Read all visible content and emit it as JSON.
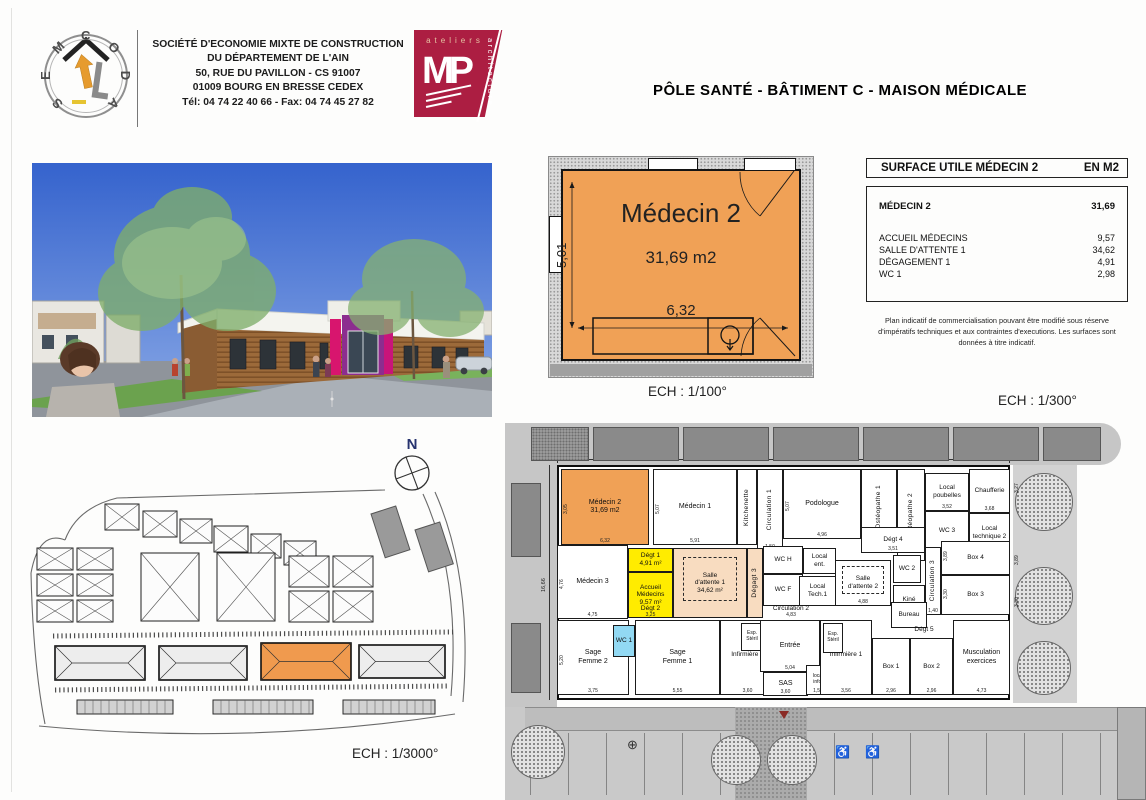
{
  "header": {
    "semcoda_name": "SEMCODA",
    "company_lines": [
      "SOCIÉTÉ D'ECONOMIE MIXTE DE CONSTRUCTION",
      "DU DÉPARTEMENT DE L'AIN",
      "50, RUE DU PAVILLON - CS 91007",
      "01009 BOURG EN BRESSE CEDEX",
      "Tél: 04 74 22 40 66 - Fax: 04 74 45 27 82"
    ],
    "mp_logo": {
      "word_top": "ateliers",
      "word_side": "architecture",
      "initials": "MP"
    },
    "title": "PÔLE SANTÉ - BÂTIMENT C - MAISON MÉDICALE"
  },
  "detail_plan": {
    "room_name": "Médecin 2",
    "area_label": "31,69 m2",
    "dim_width": "6,32",
    "dim_height": "5,01",
    "scale_label": "ECH : 1/100°"
  },
  "surface_table": {
    "title": "SURFACE UTILE MÉDECIN 2",
    "unit": "EN M2",
    "main_row": {
      "label": "MÉDECIN 2",
      "value": "31,69"
    },
    "rows": [
      {
        "label": "ACCUEIL MÉDECINS",
        "value": "9,57"
      },
      {
        "label": "SALLE D'ATTENTE 1",
        "value": "34,62"
      },
      {
        "label": "DÉGAGEMENT 1",
        "value": "4,91"
      },
      {
        "label": "WC 1",
        "value": "2,98"
      }
    ],
    "note": "Plan indicatif de commercialisation pouvant être modifié sous réserve d'impératifs techniques et aux contraintes d'executions. Les surfaces sont données à titre indicatif."
  },
  "site_plan": {
    "north_label": "N",
    "scale_label": "ECH : 1/3000°",
    "roads": [
      "M40,62 Q52,30 92,20 L360,12",
      "M398,16 Q436,100 426,218",
      "M410,14 Q448,100 438,224",
      "M14,248 Q225,268 430,236",
      "M6,95 Q8,185 20,246",
      "M6,95 Q14,52 40,62"
    ],
    "parking_lines": [
      {
        "x1": 28,
        "y1": 158,
        "x2": 428,
        "y2": 154
      },
      {
        "x1": 30,
        "y1": 212,
        "x2": 424,
        "y2": 208
      }
    ],
    "houses": [
      {
        "x": 80,
        "y": 26,
        "w": 34,
        "h": 26
      },
      {
        "x": 118,
        "y": 33,
        "w": 34,
        "h": 26
      },
      {
        "x": 155,
        "y": 41,
        "w": 32,
        "h": 24
      },
      {
        "x": 189,
        "y": 48,
        "w": 34,
        "h": 26
      },
      {
        "x": 226,
        "y": 56,
        "w": 30,
        "h": 24
      },
      {
        "x": 259,
        "y": 63,
        "w": 32,
        "h": 24
      },
      {
        "x": 12,
        "y": 70,
        "w": 36,
        "h": 22
      },
      {
        "x": 52,
        "y": 70,
        "w": 36,
        "h": 22
      },
      {
        "x": 12,
        "y": 96,
        "w": 36,
        "h": 22
      },
      {
        "x": 52,
        "y": 96,
        "w": 36,
        "h": 22
      },
      {
        "x": 12,
        "y": 122,
        "w": 36,
        "h": 22
      },
      {
        "x": 52,
        "y": 122,
        "w": 36,
        "h": 22
      },
      {
        "x": 116,
        "y": 75,
        "w": 58,
        "h": 68
      },
      {
        "x": 192,
        "y": 75,
        "w": 58,
        "h": 68
      },
      {
        "x": 264,
        "y": 78,
        "w": 40,
        "h": 31
      },
      {
        "x": 308,
        "y": 78,
        "w": 40,
        "h": 31
      },
      {
        "x": 264,
        "y": 113,
        "w": 40,
        "h": 31
      },
      {
        "x": 308,
        "y": 113,
        "w": 40,
        "h": 31
      }
    ],
    "slabs": [
      {
        "x": 346,
        "y": 36,
        "w": 26,
        "h": 46,
        "rot": -18
      },
      {
        "x": 390,
        "y": 52,
        "w": 26,
        "h": 44,
        "rot": -18
      }
    ],
    "long_buildings": [
      {
        "x": 30,
        "y": 168,
        "w": 90,
        "h": 34,
        "fill": "#ededed"
      },
      {
        "x": 134,
        "y": 168,
        "w": 88,
        "h": 34,
        "fill": "#ededed"
      },
      {
        "x": 236,
        "y": 165,
        "w": 90,
        "h": 37,
        "fill": "#f09a4e"
      },
      {
        "x": 334,
        "y": 167,
        "w": 86,
        "h": 33,
        "fill": "#ededed"
      }
    ],
    "garages": [
      {
        "x": 52,
        "y": 222,
        "w": 96,
        "h": 14
      },
      {
        "x": 188,
        "y": 222,
        "w": 100,
        "h": 14
      },
      {
        "x": 318,
        "y": 222,
        "w": 92,
        "h": 14
      }
    ]
  },
  "floor_plan": {
    "scale_label": "ECH : 1/300°",
    "dim_top": "34,56",
    "dim_left": "16,66",
    "canopy_panels": [
      {
        "x": 26,
        "y": 12,
        "w": 58,
        "h": 34,
        "speckled": true
      },
      {
        "x": 88,
        "y": 12,
        "w": 86,
        "h": 34
      },
      {
        "x": 178,
        "y": 12,
        "w": 86,
        "h": 34
      },
      {
        "x": 268,
        "y": 12,
        "w": 86,
        "h": 34
      },
      {
        "x": 358,
        "y": 12,
        "w": 86,
        "h": 34
      },
      {
        "x": 448,
        "y": 12,
        "w": 86,
        "h": 34
      },
      {
        "x": 538,
        "y": 12,
        "w": 58,
        "h": 34
      }
    ],
    "side_panels": [
      {
        "x": 6,
        "y": 68,
        "w": 30,
        "h": 74
      },
      {
        "x": 6,
        "y": 208,
        "w": 30,
        "h": 70
      }
    ],
    "trees": [
      {
        "x": 510,
        "y": 58,
        "d": 56
      },
      {
        "x": 510,
        "y": 152,
        "d": 56
      },
      {
        "x": 512,
        "y": 226,
        "d": 52
      },
      {
        "x": 6,
        "y": 310,
        "d": 52
      },
      {
        "x": 206,
        "y": 320,
        "d": 48
      },
      {
        "x": 262,
        "y": 320,
        "d": 48
      }
    ],
    "side_dims": [
      {
        "label": "3,27",
        "x": 509,
        "y": 78
      },
      {
        "label": "3,89",
        "x": 509,
        "y": 150
      },
      {
        "label": "3,30",
        "x": 509,
        "y": 192
      }
    ],
    "rooms": [
      {
        "id": "medecin-2",
        "label": "Médecin 2",
        "area": "31,69 m2",
        "x": 56,
        "y": 54,
        "w": 88,
        "h": 76,
        "fill": "#f0a156",
        "dim": "6,32",
        "vdim": "3,05",
        "fs": 7
      },
      {
        "id": "medecin-1",
        "label": "Médecin 1",
        "x": 148,
        "y": 54,
        "w": 84,
        "h": 76,
        "dim": "5,91",
        "vdim": "5,07",
        "fs": 7
      },
      {
        "id": "kitchenette",
        "label": "Kitchenette",
        "x": 232,
        "y": 54,
        "w": 20,
        "h": 76,
        "vertical": true
      },
      {
        "id": "circulation-1",
        "label": "Circulation 1",
        "x": 252,
        "y": 54,
        "w": 26,
        "h": 82,
        "vertical": true,
        "dim": "1,50"
      },
      {
        "id": "podologue",
        "label": "Podologue",
        "x": 278,
        "y": 54,
        "w": 78,
        "h": 70,
        "dim": "4,96",
        "vdim": "5,07",
        "fs": 7
      },
      {
        "id": "osteopathe-1",
        "label": "Ostéopathe 1",
        "x": 356,
        "y": 54,
        "w": 36,
        "h": 76,
        "vertical": true,
        "dim": "3,97"
      },
      {
        "id": "osteopathe-2",
        "label": "Ostéopathe 2",
        "x": 392,
        "y": 54,
        "w": 28,
        "h": 92,
        "vertical": true
      },
      {
        "id": "local-poubelles",
        "label": "Local\npoubelles",
        "x": 420,
        "y": 58,
        "w": 44,
        "h": 38,
        "dim": "3,52"
      },
      {
        "id": "wc-3",
        "label": "WC 3",
        "x": 420,
        "y": 96,
        "w": 44,
        "h": 40
      },
      {
        "id": "chaufferie",
        "label": "Chaufferie",
        "x": 464,
        "y": 54,
        "w": 41,
        "h": 44,
        "dim": "3,68"
      },
      {
        "id": "local-technique-2",
        "label": "Local\ntechnique 2",
        "x": 464,
        "y": 98,
        "w": 41,
        "h": 40
      },
      {
        "id": "degt-4",
        "label": "Dégt 4",
        "x": 356,
        "y": 112,
        "w": 64,
        "h": 26,
        "dim": "3,51"
      },
      {
        "id": "medecin-3",
        "label": "Médecin 3",
        "x": 52,
        "y": 130,
        "w": 71,
        "h": 74,
        "dim": "4,75",
        "vdim": "4,76",
        "fs": 7
      },
      {
        "id": "degt-1",
        "label": "Dégt 1\n4,91 m²",
        "x": 123,
        "y": 133,
        "w": 45,
        "h": 24,
        "fill": "#ffec00"
      },
      {
        "id": "accueil-medecins",
        "label": "Accueil\nMédecins\n9,57 m²",
        "x": 123,
        "y": 157,
        "w": 45,
        "h": 46,
        "fill": "#ffec00"
      },
      {
        "id": "salle-attente-1",
        "label": "Salle\nd'attente 1\n34,62 m²",
        "x": 168,
        "y": 133,
        "w": 74,
        "h": 70,
        "fill": "#f8dcc0",
        "dashed": true
      },
      {
        "id": "degagement-3",
        "label": "Dégagt 3",
        "x": 242,
        "y": 133,
        "w": 16,
        "h": 70,
        "vertical": true,
        "fill": "#f8dcc0"
      },
      {
        "id": "wc-h",
        "label": "WC H",
        "x": 258,
        "y": 131,
        "w": 40,
        "h": 28
      },
      {
        "id": "wc-f",
        "label": "WC F",
        "x": 258,
        "y": 159,
        "w": 40,
        "h": 32
      },
      {
        "id": "local-ent",
        "label": "Local\nent.",
        "x": 298,
        "y": 133,
        "w": 33,
        "h": 26
      },
      {
        "id": "local-tech-1",
        "label": "Local\nTech.1",
        "x": 294,
        "y": 161,
        "w": 37,
        "h": 30
      },
      {
        "id": "salle-attente-2",
        "label": "Salle\nd'attente 2",
        "x": 330,
        "y": 145,
        "w": 56,
        "h": 46,
        "dashed": true,
        "dim": "4,88"
      },
      {
        "id": "wc-2",
        "label": "WC 2",
        "x": 388,
        "y": 140,
        "w": 28,
        "h": 28
      },
      {
        "id": "kine",
        "label": "Kiné",
        "x": 388,
        "y": 170,
        "w": 32,
        "h": 30,
        "dim": "2,78"
      },
      {
        "id": "circulation-3",
        "label": "Circulation 3",
        "x": 420,
        "y": 132,
        "w": 16,
        "h": 68,
        "vertical": true,
        "dim": "1,40"
      },
      {
        "id": "box-4",
        "label": "Box 4",
        "x": 436,
        "y": 126,
        "w": 69,
        "h": 34,
        "vdim": "3,89"
      },
      {
        "id": "box-3",
        "label": "Box 3",
        "x": 436,
        "y": 160,
        "w": 69,
        "h": 40,
        "vdim": "3,30"
      },
      {
        "id": "circulation-2",
        "label": "Circulation 2",
        "x": 240,
        "y": 185,
        "w": 92,
        "h": 18,
        "open": true,
        "dim": "4,83"
      },
      {
        "id": "degt-2",
        "label": "Dégt 2",
        "x": 123,
        "y": 185,
        "w": 45,
        "h": 18,
        "open": true,
        "dim": "3,25"
      },
      {
        "id": "bureau",
        "label": "Bureau",
        "x": 386,
        "y": 187,
        "w": 36,
        "h": 26
      },
      {
        "id": "degt-5",
        "label": "Dégt 5",
        "x": 398,
        "y": 207,
        "w": 42,
        "h": 16,
        "open": true
      },
      {
        "id": "sage-femme-2",
        "label": "Sage\nFemme 2",
        "x": 52,
        "y": 205,
        "w": 72,
        "h": 75,
        "dim": "3,75",
        "vdim": "5,20",
        "fs": 7
      },
      {
        "id": "wc-1",
        "label": "WC 1",
        "x": 108,
        "y": 210,
        "w": 22,
        "h": 32,
        "fill": "#92d9f3"
      },
      {
        "id": "sage-femme-1",
        "label": "Sage\nFemme 1",
        "x": 130,
        "y": 205,
        "w": 85,
        "h": 75,
        "dim": "5,55",
        "fs": 7
      },
      {
        "id": "infirmiere-2",
        "label": "Infirmière 2",
        "x": 215,
        "y": 205,
        "w": 55,
        "h": 75,
        "dim": "3,60",
        "ly": 30
      },
      {
        "id": "esp-steril-1",
        "label": "Esp.\nStéril",
        "x": 236,
        "y": 208,
        "w": 22,
        "h": 28,
        "fs": 5
      },
      {
        "id": "entree",
        "label": "Entrée",
        "x": 255,
        "y": 205,
        "w": 60,
        "h": 52,
        "dim": "5,04",
        "fs": 7
      },
      {
        "id": "sas",
        "label": "SAS",
        "x": 258,
        "y": 257,
        "w": 45,
        "h": 24,
        "dim": "3,60",
        "fs": 7
      },
      {
        "id": "local-info",
        "label": "local\ninfo.",
        "x": 301,
        "y": 250,
        "w": 24,
        "h": 30,
        "dim": "1,54",
        "fs": 5
      },
      {
        "id": "infirmiere-1",
        "label": "Infirmière 1",
        "x": 315,
        "y": 205,
        "w": 52,
        "h": 75,
        "dim": "3,56",
        "ly": 30
      },
      {
        "id": "esp-steril-2",
        "label": "Esp.\nStéril",
        "x": 318,
        "y": 208,
        "w": 20,
        "h": 30,
        "fs": 5
      },
      {
        "id": "box-1",
        "label": "Box 1",
        "x": 367,
        "y": 223,
        "w": 38,
        "h": 57,
        "dim": "2,96"
      },
      {
        "id": "box-2",
        "label": "Box 2",
        "x": 405,
        "y": 223,
        "w": 43,
        "h": 57,
        "dim": "2,96"
      },
      {
        "id": "musculation",
        "label": "Musculation\nexercices",
        "x": 448,
        "y": 205,
        "w": 57,
        "h": 75,
        "dim": "4,73",
        "fs": 7
      }
    ]
  },
  "colors": {
    "highlight_orange": "#f0a156",
    "peach": "#f8dcc0",
    "yellow": "#ffec00",
    "wc_blue": "#92d9f3",
    "logo_crimson": "#ac1e42"
  }
}
